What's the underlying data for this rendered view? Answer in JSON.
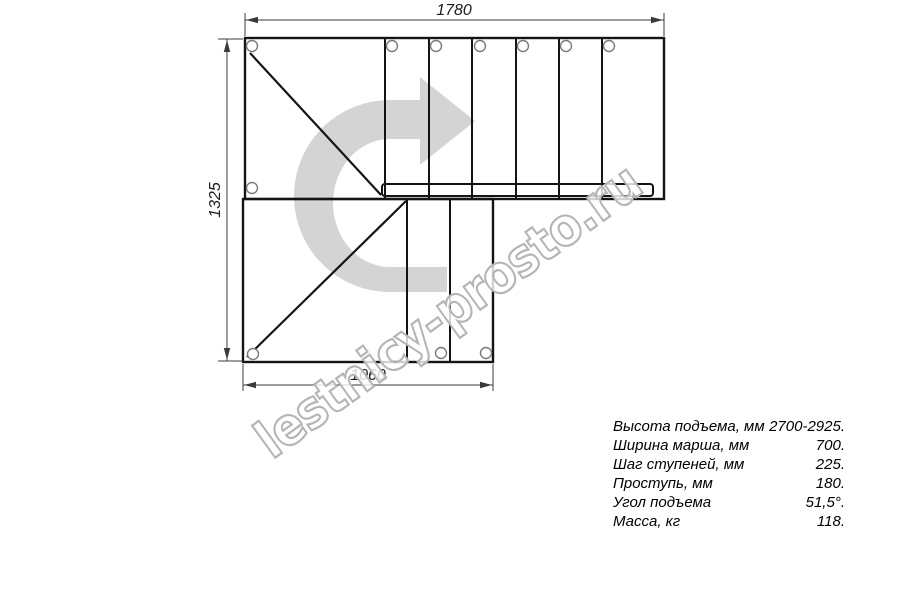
{
  "watermark": {
    "text": "lestnicy-prosto.ru",
    "stroke_color": "#b5b5b5"
  },
  "drawing": {
    "title": "staircase-plan-top-view",
    "direction_arrow": "u-turn-then-right-arrow",
    "colors": {
      "line": "#141414",
      "dim": "#3a3a3a",
      "arrow_fill": "#d4d4d4",
      "hole_stroke": "#7a7a7a"
    },
    "dimensions": {
      "top_width": "1780",
      "left_height": "1325",
      "bottom_width": "1060"
    }
  },
  "specs": {
    "rows": [
      {
        "label": "Высота подъема, мм",
        "value": "2700-2925."
      },
      {
        "label": "Ширина марша, мм",
        "value": "700."
      },
      {
        "label": "Шаг ступеней, мм",
        "value": "225."
      },
      {
        "label": "Проступь, мм",
        "value": "180."
      },
      {
        "label": "Угол подъема",
        "value": "51,5°."
      },
      {
        "label": "Масса, кг",
        "value": "118."
      }
    ]
  }
}
